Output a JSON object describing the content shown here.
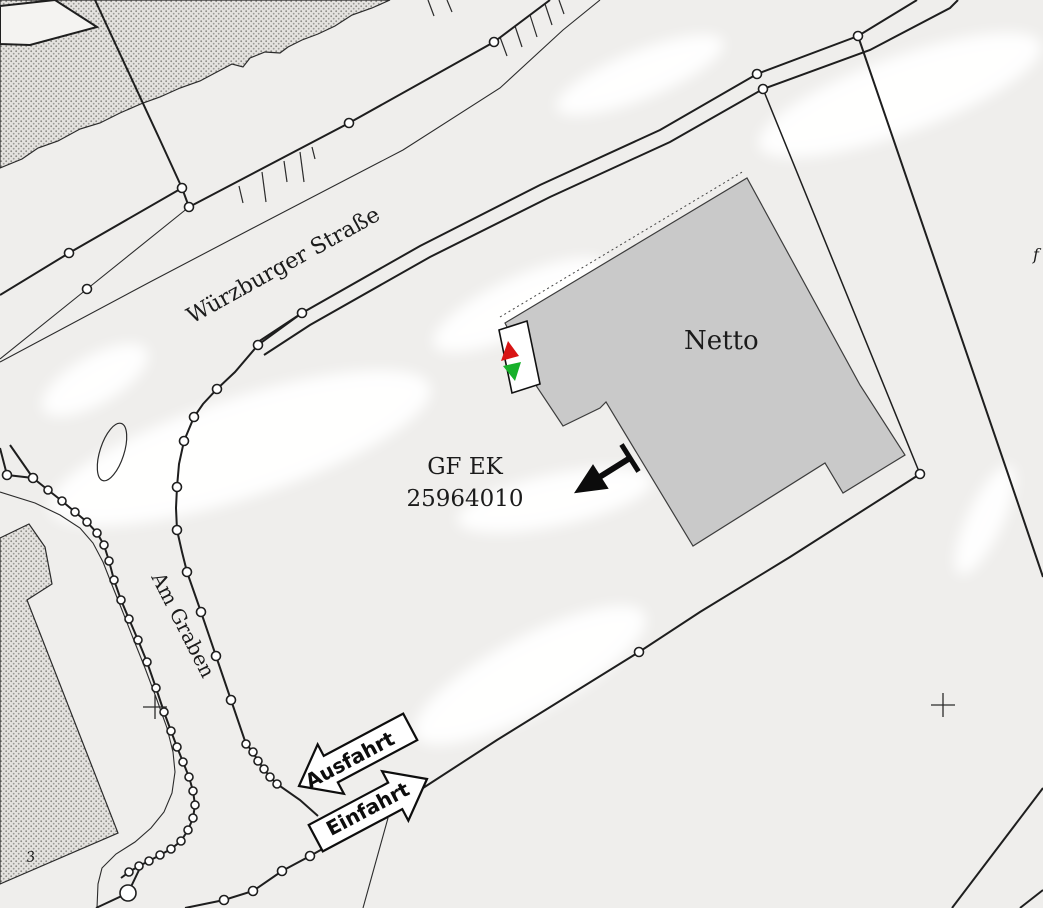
{
  "map": {
    "type": "cadastral-site-map",
    "labels": {
      "street_main": "Würzburger Straße",
      "street_side": "Am Graben",
      "building": "Netto",
      "parcel_code_line1": "GF EK",
      "parcel_code_line2": "25964010",
      "arrow_exit": "Ausfahrt",
      "arrow_entry": "Einfahrt",
      "house_number": "3",
      "edge_letter_fragment": "f"
    },
    "colors": {
      "background": "#efeeec",
      "building_fill": "#c9c9c9",
      "building_stroke": "#3c3c3c",
      "line": "#1e1e1e",
      "marker_red": "#d81414",
      "marker_green": "#17b02a",
      "arrow_fill": "#ffffff"
    },
    "symbols": {
      "entrance_marker": "red-up / green-down triangle sign at building corner",
      "direction_arrow": "black flag arrow pointing down-left from building edge",
      "survey_points": "small white circles on boundary lines",
      "survey_crosses": 2
    }
  }
}
